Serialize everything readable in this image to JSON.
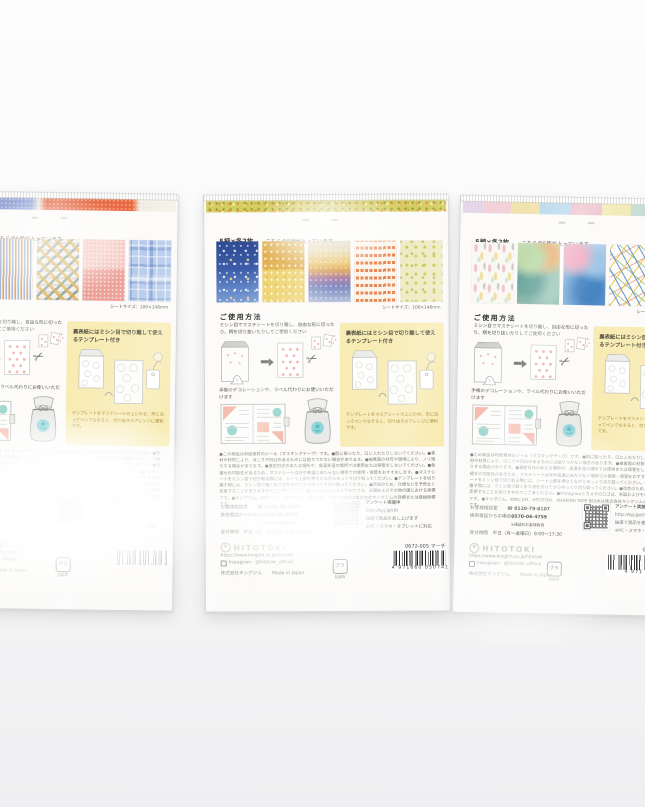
{
  "photo": {
    "backdrop_top": "#fdfdfd",
    "backdrop_bottom": "#eff0f1"
  },
  "shared": {
    "count_label": "5柄×各2枚",
    "count_note": "こちらの5柄が入っています",
    "sheet_size_label": "シートサイズ：100×148mm",
    "usage": {
      "heading": "ご使用方法",
      "body": "ミシン目でマステシートを切り離し、自由な形に切ったり、柄を切り抜いたりしてご使用ください",
      "deco_note": "手帳のデコレーションや、ラベル代わりにお使いいただけます"
    },
    "template_box": {
      "title": "裏表紙にはミシン目で切り離して使えるテンプレート付き",
      "caption": "テンプレートをマステシートの上にのせ、形に沿ってペンでなぞると、切り抜きのアレンジに便利です。",
      "bg_color": "#f8ecb4"
    },
    "fine_print": "●この商品は和紙素材のシール（マスキングテープ）です。●肌に貼ったり、口に入れたりしないでください。●素材や材質により、ほこりや凹凸のあるものには貼りつかない場合があります。●被着面の材質や環境により、ノリ残りする場合があります。●直射日光のあたる場所や、高温多湿の場所では使用または保管をしないでください。●色褪せの可能性があるため、マステシートは光や高温にあたらない場所での使用・保管をおすすめします。●マステシートをミシン目で切り取る際には、シート上部を押さえながらゆっくり切り取ってください。●テンプレートを切り離す際には、ミシン目で軽く折り目を付けてからゆっくり切り取ってください。●改良のため、仕様などを予告なく変更することがありますのでご了承ください。●Instagramとカメラのロゴは、米国およびその他の国における商標です。●キングジム、KING JIM、HITOTOKI、MASKING TAPE BOOKは株式会社キングジムの商標または登録商標です。",
    "contact": {
      "label1": "お客様相談室",
      "phone1": "0120-79-8107",
      "label2": "携帯電話からの場合",
      "phone2": "0570-06-4759",
      "phone2_note": "※通話料お客様負担",
      "hours": "受付時間　平日（月～金曜日）9:00～17:30"
    },
    "survey": {
      "title": "アンケート実施中",
      "url": "http://kyj.jp/r/h",
      "line2": "抽選で賞品を差し上げます",
      "line3": "※PC・スマホ・タブレットに対応"
    },
    "brand": {
      "name": "HITOTOKI",
      "site_url": "https://www.kingjim.co.jp/hitotoki",
      "instagram": "Instagram：@hitotoki_official",
      "company_line": "株式会社キングジム",
      "origin": "Made in Japan",
      "recycle_mark": "プラ",
      "recycle_caption": "包装袋"
    },
    "icons": {
      "scissors": "✂",
      "phone": "☎"
    }
  },
  "packages": [
    {
      "position": "left",
      "product_code": "",
      "barcode_number": "",
      "swatch_patterns": [
        "stripes",
        "stripes",
        "mosaic-confetti",
        "pink-speckle",
        "blue-plaid"
      ]
    },
    {
      "position": "middle",
      "product_code": "0672-005 マーチ",
      "barcode_number": "4 971660 050741",
      "swatch_patterns": [
        "starry-night",
        "gold-floral",
        "sunset-gradient",
        "orange-rows",
        "chartreuse-floral"
      ]
    },
    {
      "position": "right",
      "product_code": "0672-0",
      "barcode_number": "4 971",
      "swatch_patterns": [
        "pastel-strokes",
        "watercolor-green",
        "watercolor-blue",
        "confetti-dashes",
        "confetti-dashes"
      ]
    }
  ]
}
